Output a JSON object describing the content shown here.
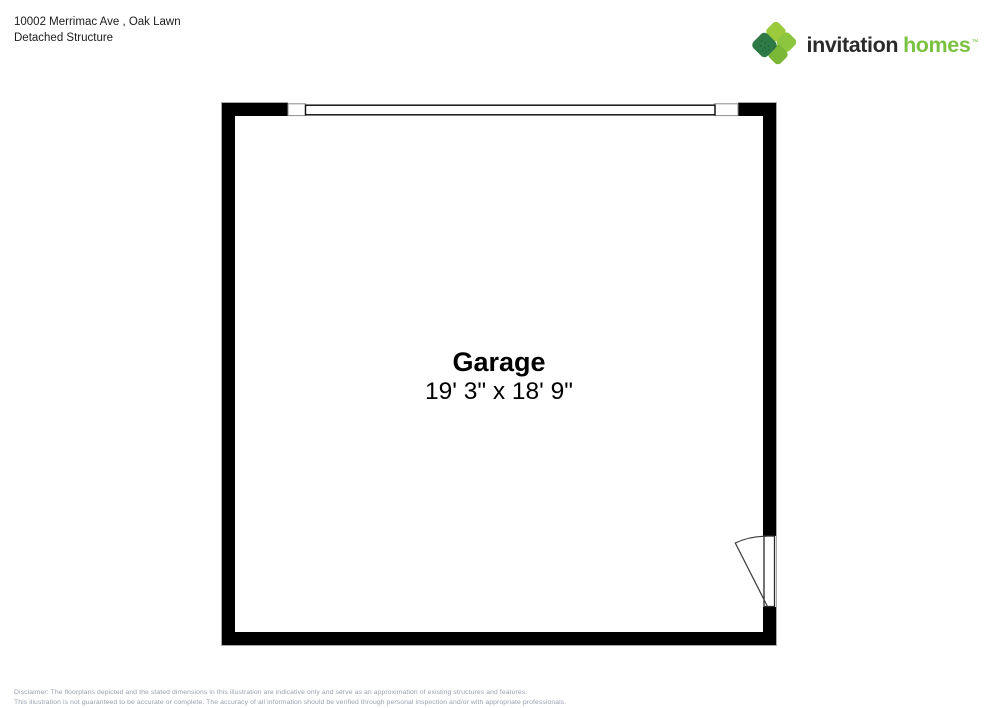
{
  "header": {
    "address": "10002 Merrimac Ave , Oak Lawn",
    "subtitle": "Detached Structure"
  },
  "brand": {
    "word1": "invitation",
    "word2": "homes",
    "trademark": "™",
    "colors": {
      "dark_text": "#2b2b2b",
      "green_text": "#7cc242",
      "petal_light": "#9bcb3c",
      "petal_mid": "#8cc63f",
      "petal_deep": "#7ab737",
      "petal_dark": "#2e7a46"
    }
  },
  "floorplan": {
    "room_name": "Garage",
    "room_dimensions": "19' 3\" x 18' 9\"",
    "wall_color": "#000000",
    "icons": [
      "garage-door-opening-icon",
      "swing-door-icon"
    ]
  },
  "disclaimer": {
    "line1": "Disclaimer: The floorplans depicted and the stated dimensions in this illustration are indicative only and serve as an approximation of existing structures and features.",
    "line2": "This illustration is not guaranteed to be accurate or complete. The accuracy of all information should be verified through personal inspection and/or with appropriate professionals."
  }
}
